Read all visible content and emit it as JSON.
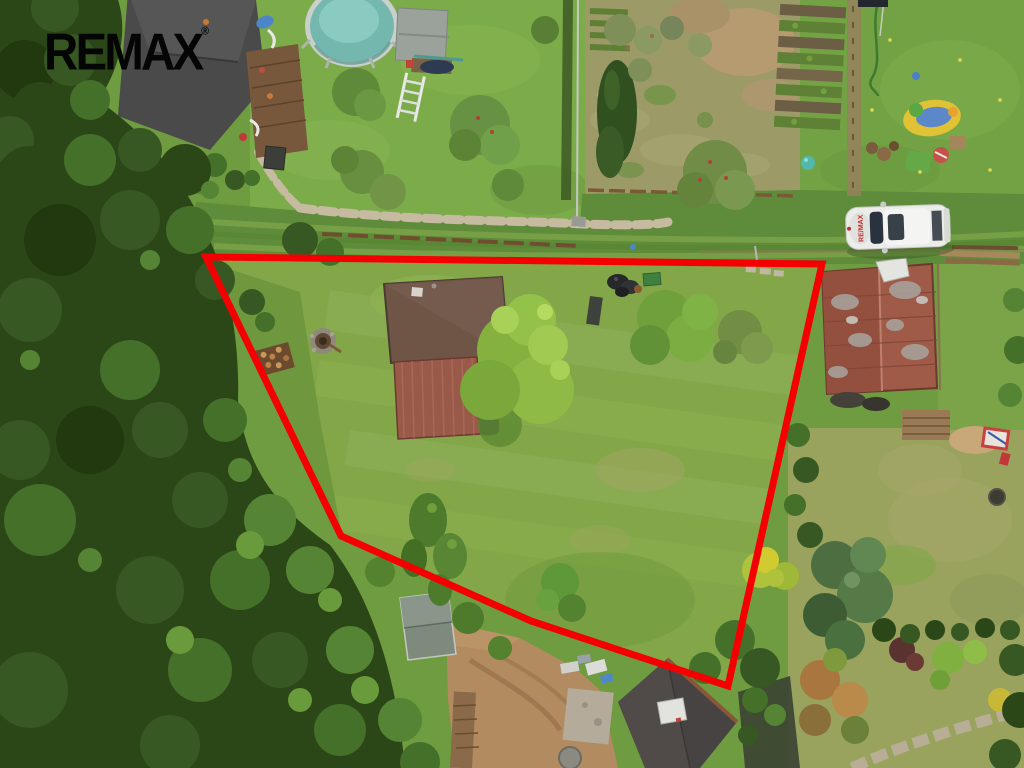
{
  "watermark": {
    "brand": "REMAX",
    "registered": "®"
  },
  "boundary": {
    "points": "206,257 822,264 728,686 531,621 341,536",
    "color": "#F50002",
    "stroke_width": 7
  },
  "vehicle": {
    "hood_label": "RE/MAX",
    "body_color": "#ECEDEA",
    "label_color": "#C22B2B"
  },
  "palette": {
    "base_grass": "#6F9B41",
    "property_lawn": "#83A748",
    "track": "#5E8C3A",
    "dry_garden": "#9C9A66",
    "right_lawn": "#73A245",
    "bottom_right_lawn": "#99A35E",
    "dirt": "#B28B60",
    "forest": "#2C4717",
    "pool_water": "#74B7AE",
    "roof_topleft_house": "#4A4A4A",
    "roof_main_house": "#6E5546",
    "roof_red_shed": "#9A5A4A",
    "roof_rust_barn": "#A05A48",
    "roof_bottom_house": "#474342",
    "roof_garden_shed": "#7E8A7C"
  }
}
